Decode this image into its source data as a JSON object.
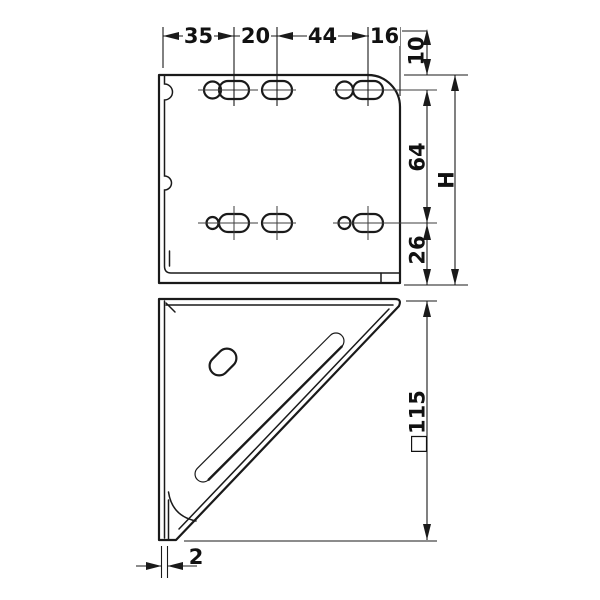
{
  "drawing": {
    "background": "#ffffff",
    "line_color": "#1a1a1a",
    "views": {
      "vertical_leg": "bracket face view with two rows of round and slotted holes",
      "gusset": "triangular gusset view with angled slot and oval hole"
    },
    "dimensions": {
      "top_chain": [
        "35",
        "20",
        "44",
        "16"
      ],
      "top_edge_to_row1": "10",
      "row1_to_row2": "64",
      "row2_to_bottom": "26",
      "overall_height": "H",
      "gusset_size": "□115",
      "material_thickness": "2"
    }
  }
}
